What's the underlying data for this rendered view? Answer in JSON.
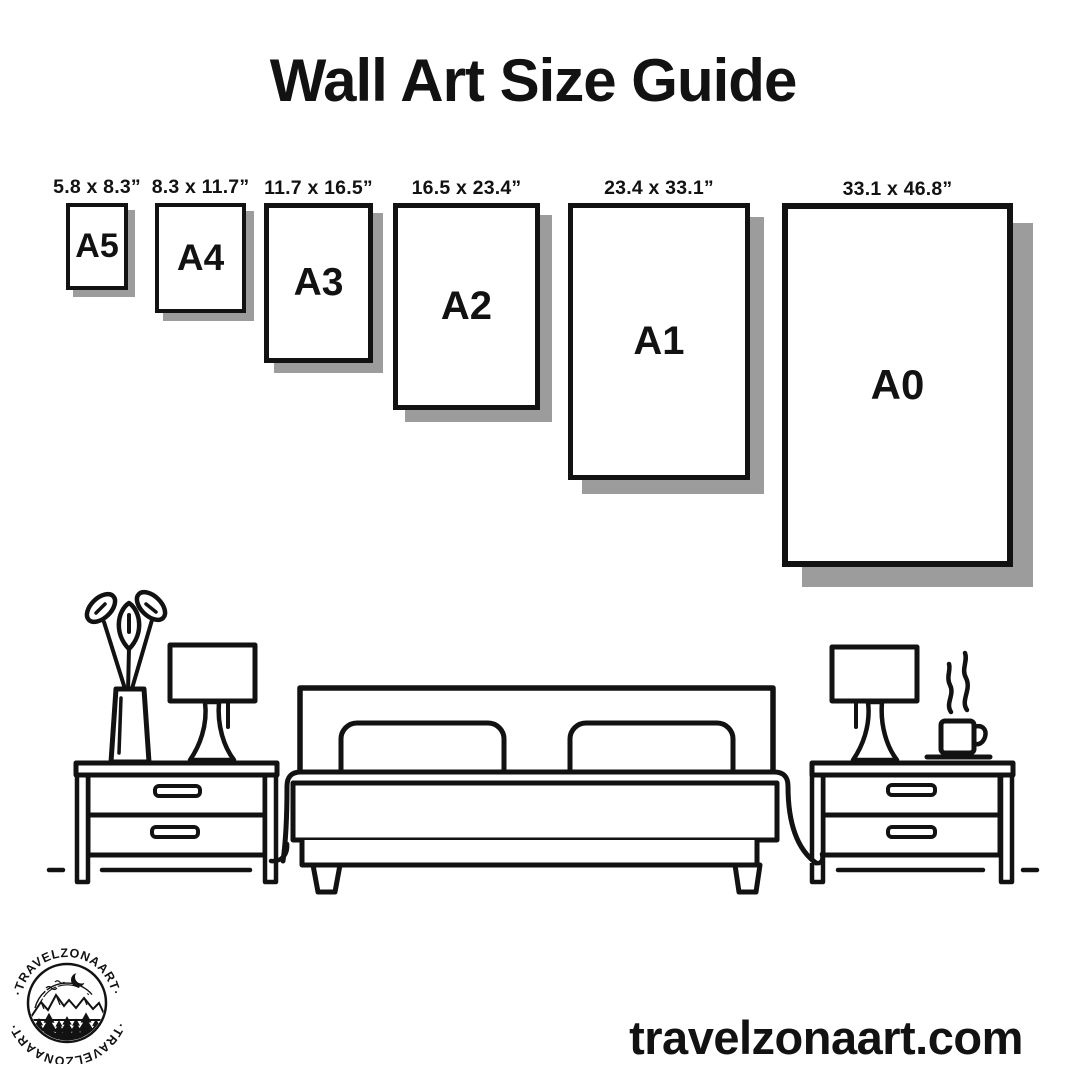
{
  "title": "Wall Art Size Guide",
  "sizes": [
    {
      "label": "A5",
      "dimensions": "5.8 x 8.3”"
    },
    {
      "label": "A4",
      "dimensions": "8.3 x 11.7”"
    },
    {
      "label": "A3",
      "dimensions": "11.7 x 16.5”"
    },
    {
      "label": "A2",
      "dimensions": "16.5 x 23.4”"
    },
    {
      "label": "A1",
      "dimensions": "23.4 x 33.1”"
    },
    {
      "label": "A0",
      "dimensions": "33.1 x 46.8”"
    }
  ],
  "website": "travelzonaart.com",
  "logo": {
    "text_top": "·TRAVELZONAART·",
    "text_bottom": "·TRAVELZONAART·"
  },
  "illustration": {
    "icons": [
      "potted-plant-icon",
      "table-lamp-icon",
      "nightstand-icon",
      "double-bed-icon",
      "coffee-cup-icon",
      "steam-icon",
      "floor-line"
    ]
  },
  "colors": {
    "ink": "#121212",
    "shadow": "#9c9c9c",
    "background": "#ffffff"
  }
}
